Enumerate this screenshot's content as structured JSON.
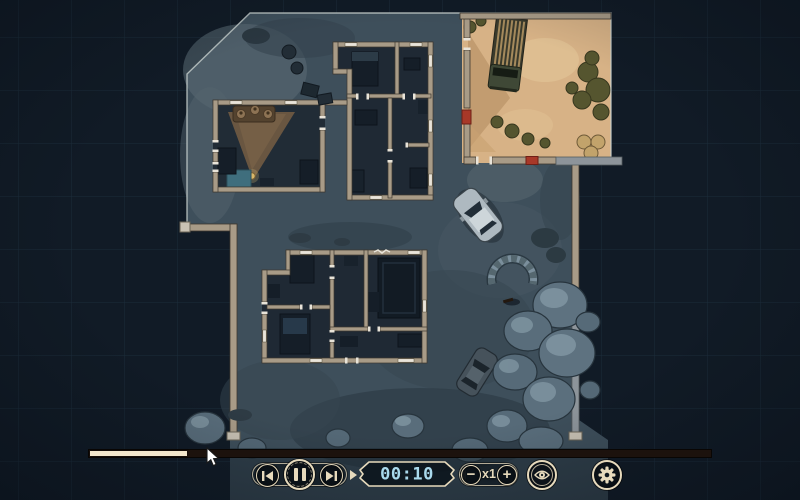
{
  "scene": {
    "description": "top-down tactical floor-plan map at night with one daylight sand courtyard",
    "palette": {
      "background": "#111b26",
      "grid_line": "#2a4254",
      "ground": "#3e4f5b",
      "room_floor": "#1f2934",
      "wall": "#a89b87",
      "door_frame": "#e9e4d9",
      "red_door": "#a83828",
      "sand_courtyard": "#d7b286",
      "rock": "#5e7280",
      "accent_cream": "#e7dabc",
      "timer_blue": "#a9d9ec"
    },
    "features": [
      "upper-building-with-lamp-room",
      "lower-building",
      "sand-courtyard-with-truck",
      "sedan-car",
      "parked-dark-car",
      "stone-half-circle",
      "rock-cluster",
      "boundary-walls"
    ]
  },
  "hud": {
    "timeline": {
      "fill_style": "width:97px",
      "fill_color": "#f2e6cc"
    },
    "playback": {
      "skip_back_icon": "skip-to-start",
      "pause_icon": "pause",
      "skip_forward_icon": "skip-to-end"
    },
    "timer": {
      "value": "00:10"
    },
    "speed": {
      "decrease": "−",
      "value": "x1",
      "increase": "+"
    },
    "view_toggle_icon": "eye",
    "settings_icon": "gear"
  }
}
